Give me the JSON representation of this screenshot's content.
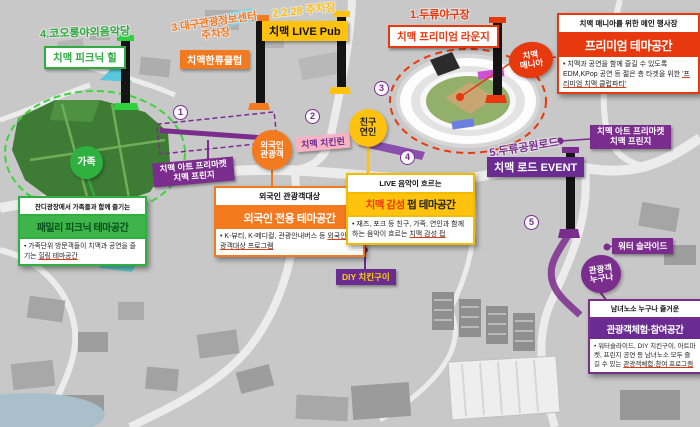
{
  "venues": {
    "v1": "1.두류야구장",
    "v2": "2.2.28 주차장",
    "v3_line1": "3.대구관광정보센터",
    "v3_line2": "주차장",
    "v4": "4.코오롱야외음악당",
    "v5": "5.두류공원로드"
  },
  "map_labels": {
    "picnic_hill": "치맥 피크닉 힐",
    "hallyu_club": "치맥한류클럽",
    "live_pub": "치맥 LIVE Pub",
    "premium_lounge": "치맥 프리미엄 라운지",
    "road_event": "치맥 로드 EVENT",
    "art_market_line1": "치맥 아트 프리마켓",
    "art_market_line2": "치맥 프린지",
    "chicken_run": "치맥 치킨런",
    "diy_chicken": "DIY 치킨구이",
    "water_slide": "워터 슬라이드"
  },
  "audience_circles": {
    "family": "가족",
    "foreign_line1": "외국인",
    "foreign_line2": "관광객",
    "friends_line1": "친구",
    "friends_line2": "연인",
    "mania_line1": "치맥",
    "mania_line2": "매니아",
    "anyone_line1": "관광객",
    "anyone_line2": "누구나"
  },
  "markers": [
    "1",
    "2",
    "3",
    "4",
    "5"
  ],
  "panels": {
    "premium": {
      "header": "치맥 매니아를 위한 메인 행사장",
      "title": "프리미엄 테마공간",
      "body": "• 치맥과 공연을 함께 즐길 수 있도록 EDM,KPop 공연 등 젊은 층 타겟을 위한 ",
      "body_em": "'프리미엄 치맥 클럽파티'"
    },
    "family": {
      "header": "잔디광장에서 가족들과 함께 즐기는",
      "title": "패밀리 피크닉 테마공간",
      "body": "• 가족단위 방문객들이 치맥과 공연을 즐기는 ",
      "body_em": "힐링 테마공간"
    },
    "foreigner": {
      "header": "외국인 관광객대상",
      "title": "외국인 전용 테마공간",
      "body": "• K-뷰티, K-메디컬, 관광안내버스 등 ",
      "body_em": "외국인 관광객대상 프로그램"
    },
    "pub": {
      "header": "LIVE 음악이 흐르는",
      "title_accent": "치맥 감성",
      "title_rest": " 펍 테마공간",
      "body": "• 재즈, 포크 등 친구, 가족, 연인과 함께하는 음악이 흐르는 ",
      "body_em": "치맥 감성 펍"
    },
    "experience": {
      "header": "남녀노소 누구나 즐거운",
      "title": "관광객체험·참여공간",
      "body": "• 워터슬라이드, DIY 치킨구이, 아트마켓, 프린지 공연 등 남녀노소 모두 즐길 수 있는 ",
      "body_em": "관광객체험·참여 프로그램"
    }
  },
  "colors": {
    "green": "#2fab3f",
    "orange": "#f47a20",
    "yellow": "#ffc20e",
    "red": "#e8380d",
    "purple": "#7b2d8e",
    "purple_dark": "#6a2c91",
    "pink": "#f7b3c2"
  }
}
